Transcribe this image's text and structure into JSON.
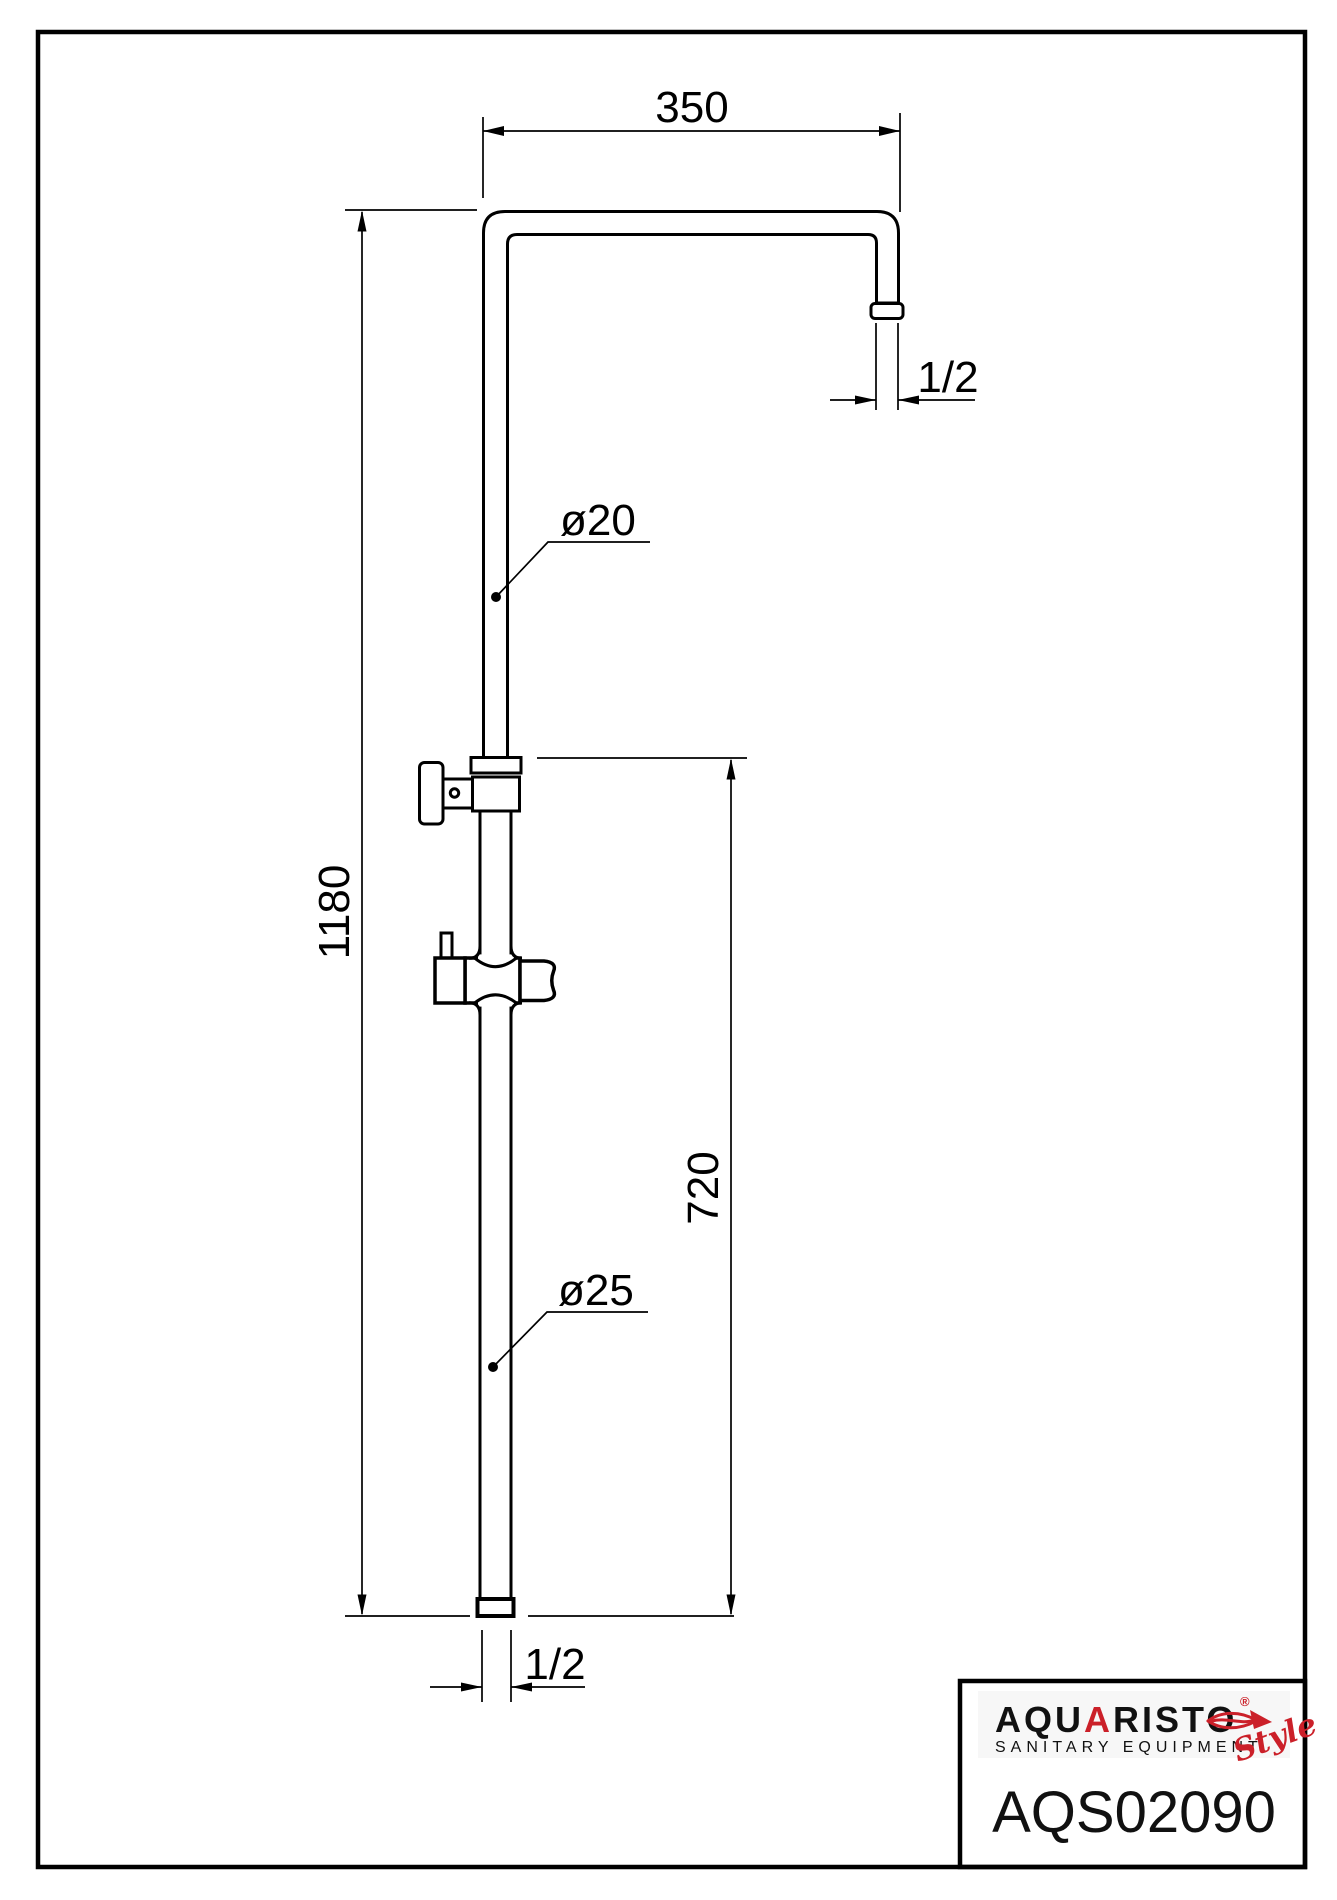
{
  "dimensions": {
    "top_width": "350",
    "top_outlet_thread": "1/2",
    "upper_pipe_diameter": "ø20",
    "total_height": "1180",
    "slider_section_height": "720",
    "lower_pipe_diameter": "ø25",
    "bottom_inlet_thread": "1/2"
  },
  "logo": {
    "brand_prefix": "AQU",
    "brand_accent_letter": "A",
    "brand_suffix": "RISTO",
    "registered_mark": "®",
    "tagline": "SANITARY EQUIPMENT",
    "style_script": "Style",
    "model_number": "AQS02090"
  },
  "colors": {
    "line": "#000000",
    "accent_red": "#cb2029",
    "background": "#ffffff"
  }
}
